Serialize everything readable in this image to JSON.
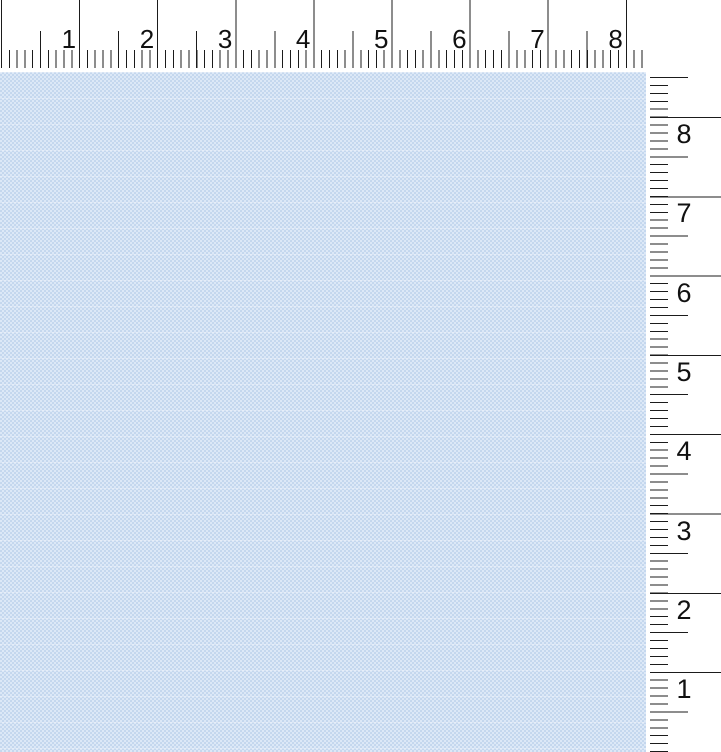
{
  "rulers": {
    "unit": "inches",
    "tick_color": "#1b1b1b",
    "background_color": "#ffffff",
    "label_color": "#111111",
    "horizontal": {
      "labels": [
        "1",
        "2",
        "3",
        "4",
        "5",
        "6",
        "7",
        "8"
      ]
    },
    "vertical": {
      "labels": [
        "8",
        "7",
        "6",
        "5",
        "4",
        "3",
        "2",
        "1"
      ]
    }
  },
  "page": {
    "background_color": "#c4d7ee",
    "dot_color": "#e0eaf8"
  }
}
